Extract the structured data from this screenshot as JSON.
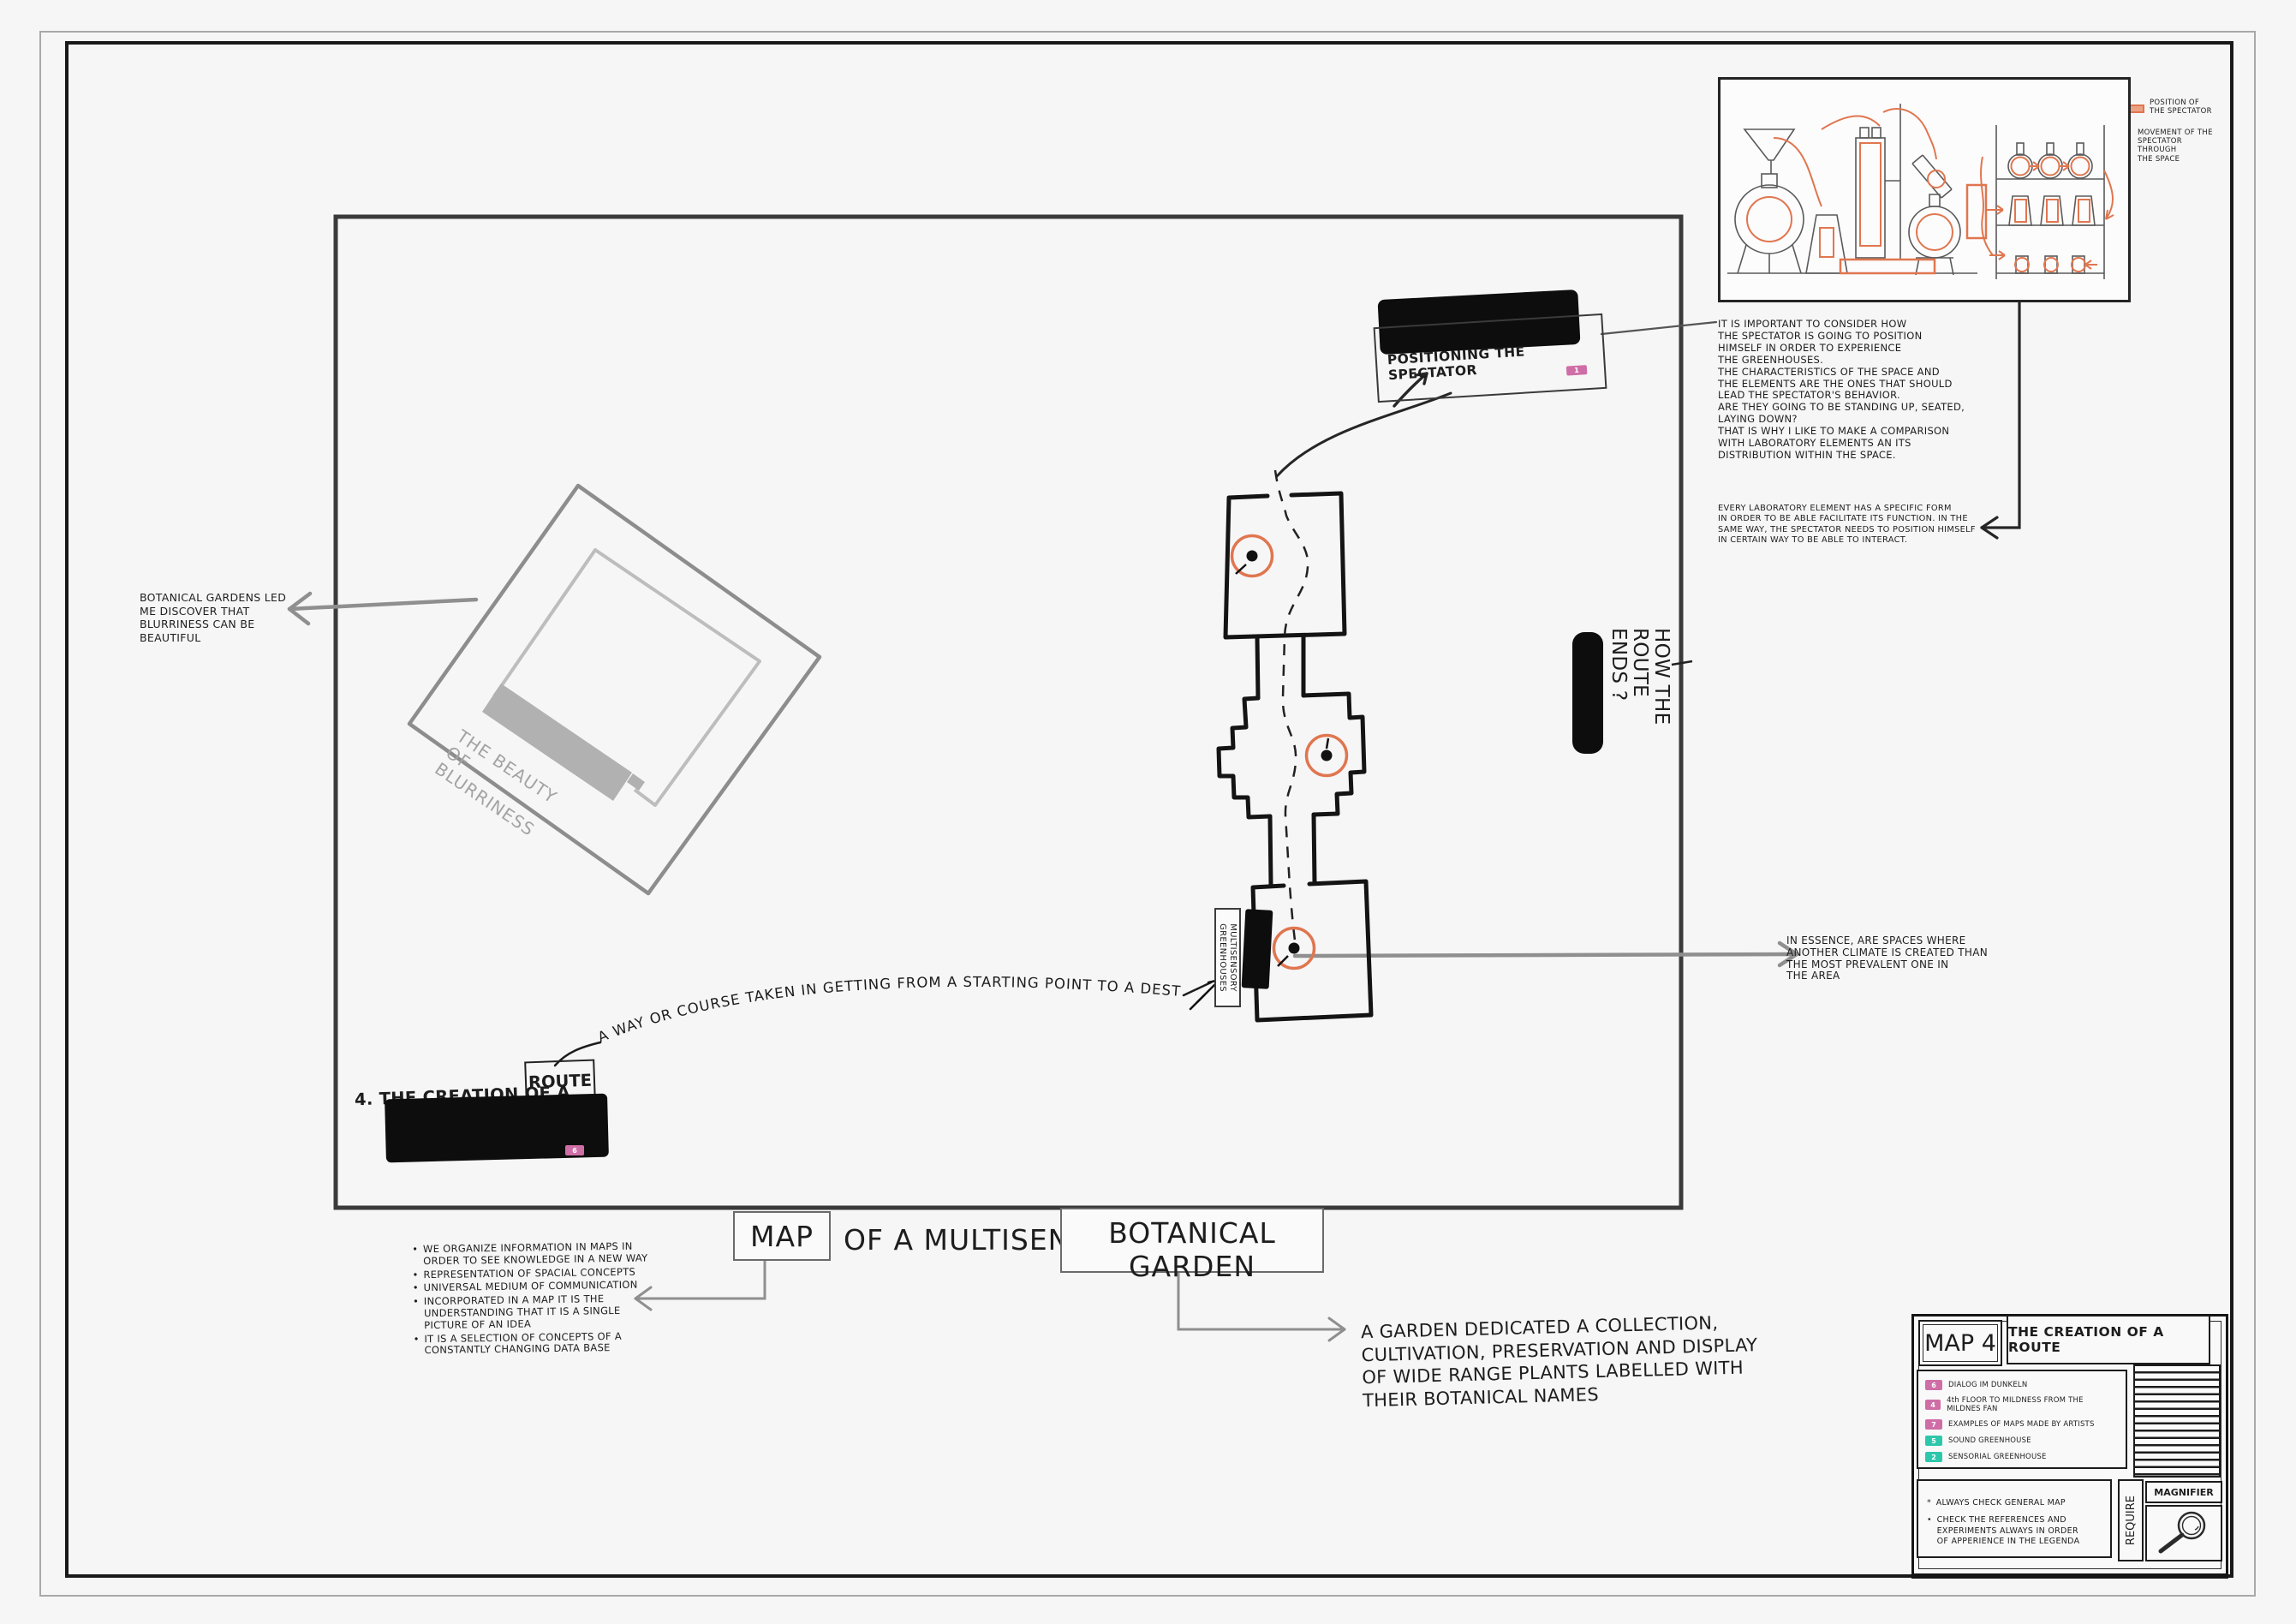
{
  "colors": {
    "orange": "#e0764f",
    "pink": "#cf6ea6",
    "teal": "#2fc7ac",
    "ink": "#1d1d1d",
    "gray_arrow": "#8f8f8f",
    "blur_gray": "#a3a3a3"
  },
  "lab": {
    "legend_position": "POSITION OF\nTHE SPECTATOR",
    "legend_movement": "MOVEMENT OF THE\nSPECTATOR THROUGH\nTHE SPACE"
  },
  "annotations": {
    "important": "IT IS IMPORTANT TO CONSIDER HOW\nTHE SPECTATOR IS GOING TO POSITION\nHIMSELF IN ORDER TO EXPERIENCE\nTHE GREENHOUSES.\nTHE CHARACTERISTICS OF THE SPACE AND\nTHE ELEMENTS ARE THE ONES THAT SHOULD\nLEAD THE SPECTATOR'S BEHAVIOR.\nARE THEY GOING TO BE STANDING UP, SEATED,\nLAYING DOWN?\nTHAT IS WHY I LIKE TO MAKE A COMPARISON\nWITH LABORATORY ELEMENTS AN ITS\nDISTRIBUTION WITHIN THE SPACE.",
    "every_lab": "EVERY LABORATORY ELEMENT HAS A SPECIFIC FORM\nIN ORDER TO BE ABLE FACILITATE ITS FUNCTION. IN THE\nSAME WAY, THE SPECTATOR NEEDS TO POSITION HIMSELF\nIN CERTAIN WAY TO BE ABLE TO INTERACT.",
    "in_essence": "IN ESSENCE, ARE SPACES WHERE\nANOTHER CLIMATE IS CREATED THAN\nTHE MOST PREVALENT ONE IN\nTHE AREA",
    "botanical_led": "BOTANICAL GARDENS LED\nME DISCOVER THAT\nBLURRINESS CAN BE\nBEAUTIFUL",
    "garden_def": "A GARDEN DEDICATED A COLLECTION,\nCULTIVATION, PRESERVATION AND DISPLAY\nOF WIDE RANGE PLANTS LABELLED WITH\nTHEIR BOTANICAL NAMES",
    "route_def_arc": "A WAY OR COURSE TAKEN IN GETTING FROM A STARTING POINT TO A DESTINATION"
  },
  "labels": {
    "positioning": "POSITIONING THE SPECTATOR",
    "positioning_badge": "1",
    "how_route_ends": "HOW THE\nROUTE\nENDS ?",
    "greenhouses": "MULTISENSORY GREENHOUSES",
    "beauty": "THE BEAUTY OF\nBLURRINESS",
    "creation_prefix": "4. THE CREATION OF A",
    "route_boxed": "ROUTE",
    "creation_badge": "6"
  },
  "title": {
    "map": "MAP",
    "rest": "OF A MULTISENSORY",
    "botanical": "BOTANICAL GARDEN"
  },
  "bullets": {
    "items": [
      "WE ORGANIZE INFORMATION IN MAPS IN\nORDER TO SEE KNOWLEDGE IN A NEW WAY",
      "REPRESENTATION OF SPACIAL CONCEPTS",
      "UNIVERSAL MEDIUM OF COMMUNICATION",
      "INCORPORATED IN A MAP IT IS THE\nUNDERSTANDING THAT IT IS A SINGLE\nPICTURE OF AN IDEA",
      "IT IS A SELECTION OF CONCEPTS OF A\nCONSTANTLY CHANGING DATA BASE"
    ]
  },
  "titleblock": {
    "map_no": "MAP 4",
    "sheet_title": "THE CREATION OF A ROUTE",
    "legend": {
      "items": [
        {
          "num": "6",
          "color": "#cf6ea6",
          "label": "DIALOG IM DUNKELN"
        },
        {
          "num": "4",
          "color": "#cf6ea6",
          "label": "4th FLOOR TO MILDNESS FROM THE MILDNES FAN"
        },
        {
          "num": "7",
          "color": "#cf6ea6",
          "label": "EXAMPLES OF MAPS MADE BY ARTISTS"
        },
        {
          "num": "5",
          "color": "#2fc7ac",
          "label": "SOUND GREENHOUSE"
        },
        {
          "num": "2",
          "color": "#2fc7ac",
          "label": "SENSORIAL GREENHOUSE"
        }
      ]
    },
    "notes": [
      {
        "bullet": "*",
        "text": "ALWAYS CHECK GENERAL MAP"
      },
      {
        "bullet": "•",
        "text": "CHECK THE REFERENCES AND\nEXPERIMENTS ALWAYS IN ORDER\nOF APPERIENCE IN THE LEGENDA"
      }
    ],
    "require": "REQUIRE",
    "magnifier": "MAGNIFIER"
  }
}
